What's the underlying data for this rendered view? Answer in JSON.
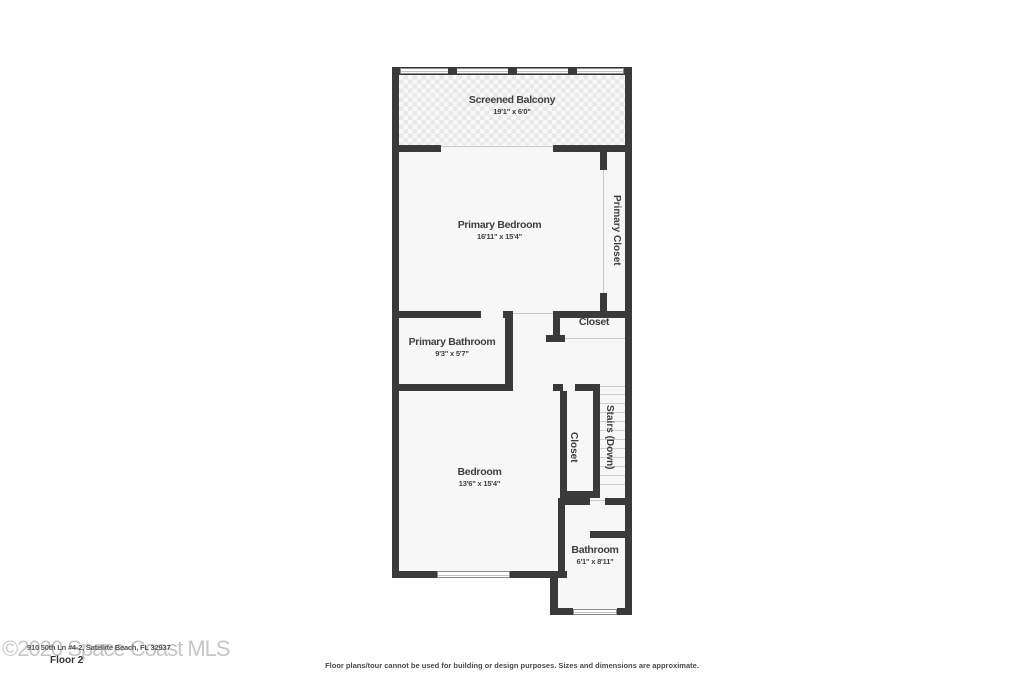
{
  "plan": {
    "rooms": [
      {
        "name": "Screened Balcony",
        "dims": "19'1\" x 6'0\""
      },
      {
        "name": "Primary Bedroom",
        "dims": "16'11\" x 15'4\""
      },
      {
        "name": "Primary Closet",
        "dims": ""
      },
      {
        "name": "Closet",
        "dims": ""
      },
      {
        "name": "Primary Bathroom",
        "dims": "9'3\" x 5'7\""
      },
      {
        "name": "Closet",
        "dims": ""
      },
      {
        "name": "Stairs (Down)",
        "dims": ""
      },
      {
        "name": "Bedroom",
        "dims": "13'6\" x 15'4\""
      },
      {
        "name": "Bathroom",
        "dims": "6'1\" x 8'11\""
      }
    ]
  },
  "footer": {
    "watermark": "©2020 Space Coast MLS",
    "address_overlay": "910 50th Ln #4-2, Satellite Beach, FL 32937",
    "floor_label": "Floor 2",
    "disclaimer": "Floor plans/tour cannot be used for building or design purposes. Sizes and dimensions are approximate."
  },
  "colors": {
    "wall": "#3a3a3a",
    "room_fill": "#f7f7f7",
    "balcony_tile": "#e9e9e9",
    "opening_line": "#c9c9c9",
    "watermark": "#c6c6c6",
    "text": "#3f3f3f"
  }
}
